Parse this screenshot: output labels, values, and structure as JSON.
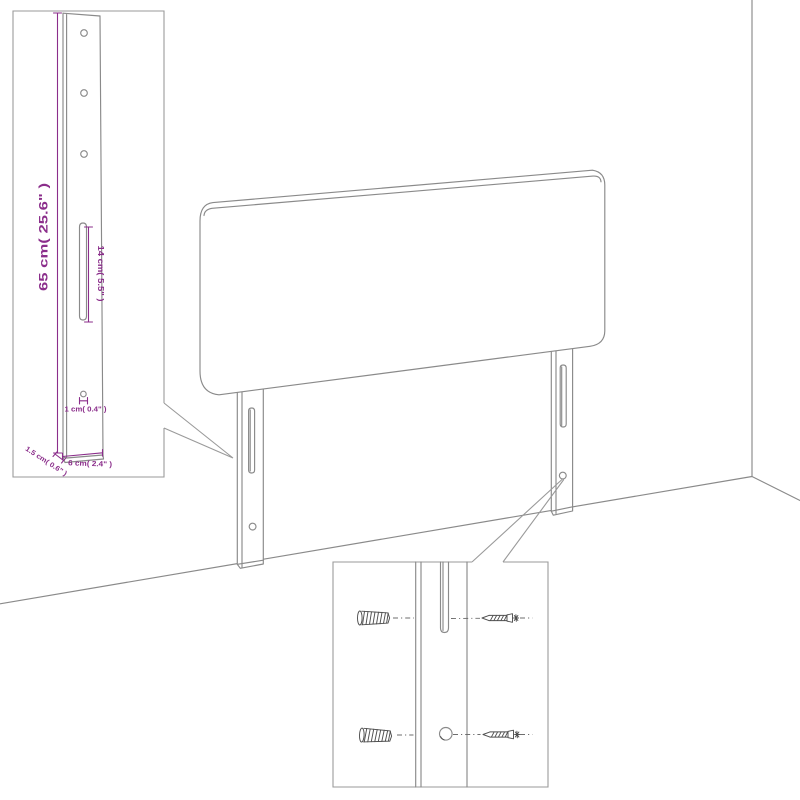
{
  "scene": {
    "type": "furniture-assembly-diagram",
    "product": "headboard-with-wall-mount-brackets"
  },
  "colors": {
    "background": "#ffffff",
    "drawing_line": "#8a8a8a",
    "inset_border": "#9a9a9a",
    "dimension_accent": "#8b2e8b",
    "hardware": "#4f4f4f"
  },
  "bracket_inset": {
    "dim_height": "65 cm( 25.6\" )",
    "dim_slot": "14 cm( 5.5\" )",
    "dim_hole": "1 cm( 0.4\" )",
    "dim_thickness": "1.5 cm( 0.6\" )",
    "dim_width": "6 cm( 2.4\" )"
  },
  "mounting_inset": {
    "icons": [
      "wall-anchor-icon",
      "screw-icon"
    ]
  }
}
